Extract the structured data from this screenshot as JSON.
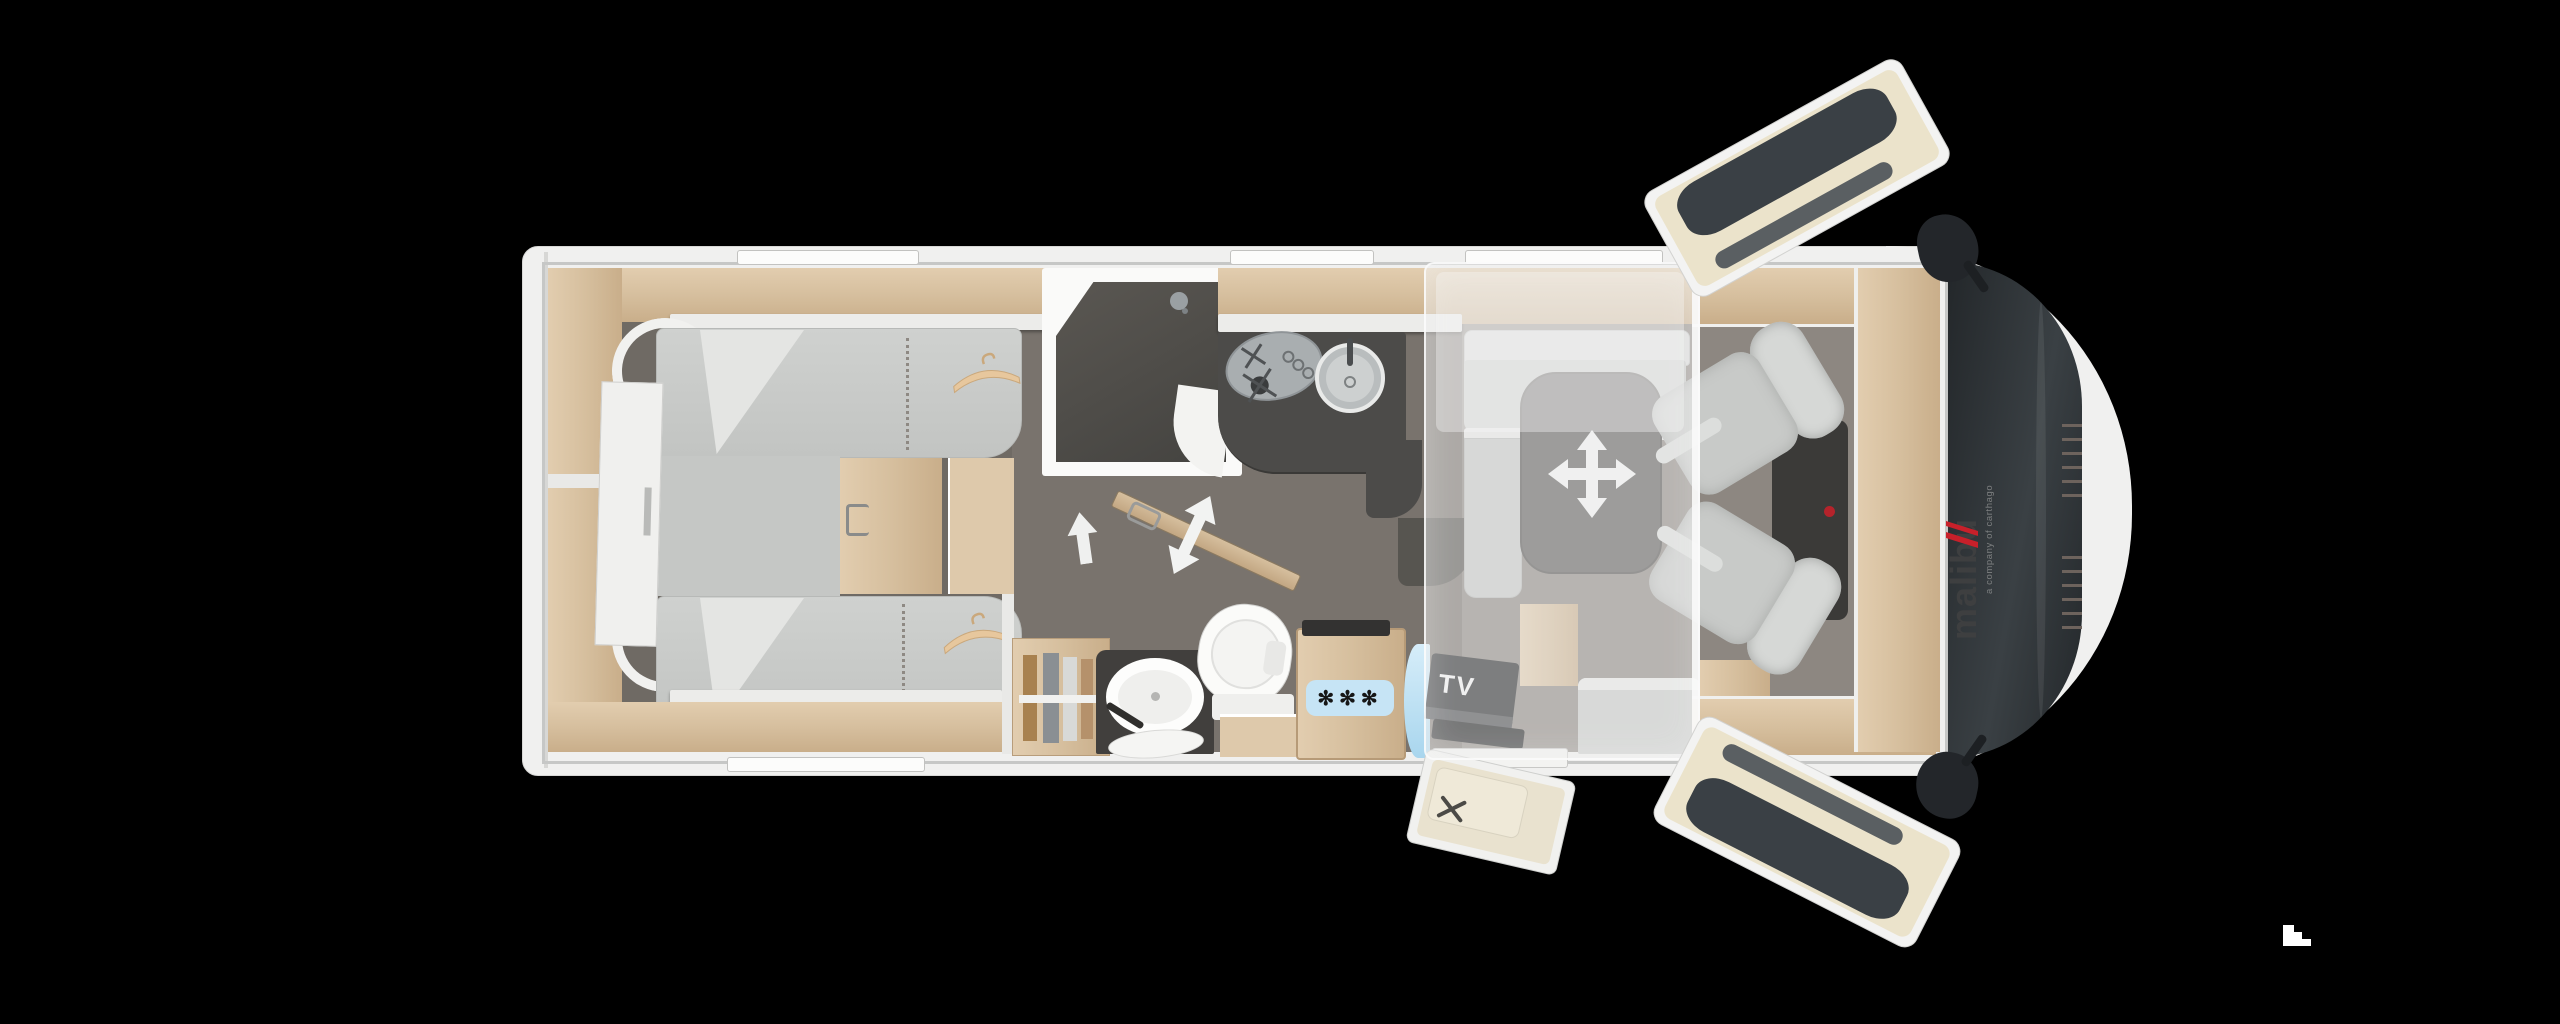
{
  "page": {
    "background": "#000000",
    "width": 2560,
    "height": 1024
  },
  "vehicle": {
    "brand": {
      "logo_text": "malibu",
      "tagline": "a company of carthago"
    },
    "labels": {
      "tv": "TV",
      "freezer": "✻✻✻"
    },
    "colors": {
      "background": "#000000",
      "shell": "#f0f0ef",
      "interior_wall": "#c6c7c6",
      "wood": "#d8c2a3",
      "wood_dark": "#c8ae8c",
      "floor_bedroom": "#6f6a64",
      "floor_bathroom": "#79736d",
      "floor_lounge": "#8d8781",
      "upholstery": "#c9cbc9",
      "worktop": "#4c4b49",
      "shower_floor": "#504e4a",
      "freezer_badge": "#c6e4f5",
      "tv_panel": "#232527",
      "windshield": "#2c3033",
      "drop_down_bed_overlay": "rgba(234,235,234,0.45)",
      "logo_text": "#3e3f40",
      "logo_accent": "#c8202a"
    },
    "icons": [
      {
        "name": "hanger-icon",
        "glyph": "coat-hanger",
        "count": 2
      },
      {
        "name": "walk-direction-arrow-icon",
        "glyph": "↑"
      },
      {
        "name": "sliding-door-arrow-icon",
        "glyph": "⇕"
      },
      {
        "name": "table-move-icon",
        "glyph": "✛"
      },
      {
        "name": "shower-head-icon",
        "glyph": "shower"
      },
      {
        "name": "steps-icon",
        "glyph": "stairs"
      }
    ]
  }
}
